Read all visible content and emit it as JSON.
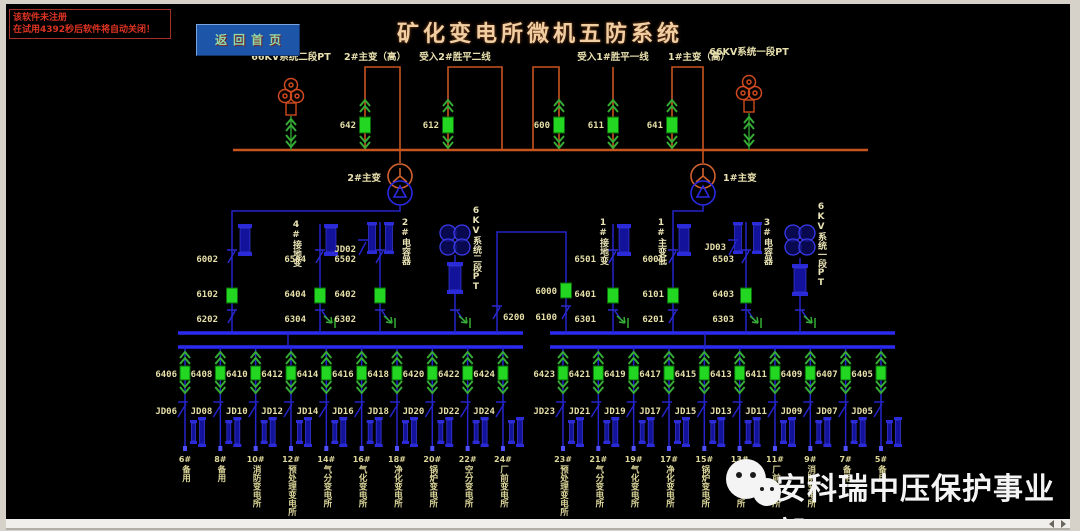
{
  "window": {
    "trial_warning": {
      "line1": "该软件未注册",
      "line2": "在试用4392秒后软件将自动关闭！"
    },
    "home_button_label": "返回首页",
    "title": "矿化变电所微机五防系统",
    "watermark_text": "安科瑞中压保护事业部"
  },
  "colors": {
    "bus_66kv": "#c8541e",
    "bus_6kv": "#2a2af0",
    "breaker_closed": "#22d622",
    "arrow_green": "#35ad35",
    "label_text": "#e6dfa8",
    "title_text": "#f1cfa2",
    "warning_text": "#dd3322",
    "button_bg": "#1d55a8"
  },
  "hv_66kv": {
    "pt_left_label": "66KV系统二段PT",
    "pt_right_label": "66KV系统一段PT",
    "bays": [
      {
        "label": "2#主变（高）",
        "breaker": "642"
      },
      {
        "label": "受入2#胜平二线",
        "breaker": "612"
      },
      {
        "label": "",
        "breaker": "600"
      },
      {
        "label": "受入1#胜平一线",
        "breaker": "611"
      },
      {
        "label": "1#主变（高）",
        "breaker": "641"
      }
    ],
    "transformer_left": "2#主变",
    "transformer_right": "1#主变"
  },
  "mv_6kv": {
    "columns_left": [
      {
        "codes": [
          "6002",
          "6102",
          "6202"
        ]
      },
      {
        "label": "4#接地变",
        "codes": [
          "6504",
          "6404",
          "6304"
        ]
      },
      {
        "label": "2#电容器",
        "jd": "JD02",
        "codes": [
          "6502",
          "6402",
          "6302"
        ]
      },
      {
        "label": "6KV系统二段PT"
      }
    ],
    "bus_tie": {
      "left_switch": "6200",
      "breaker": "6000",
      "right_switch": "6100"
    },
    "columns_right": [
      {
        "label": "1#接地变",
        "codes": [
          "6501",
          "6401",
          "6301"
        ]
      },
      {
        "label": "1#主变低",
        "codes": [
          "6001",
          "6101",
          "6201"
        ]
      },
      {
        "label": "3#电容器",
        "jd": "JD03",
        "codes": [
          "6503",
          "6403",
          "6303"
        ]
      },
      {
        "label": "6KV系统一段PT"
      }
    ]
  },
  "feeders": {
    "left": [
      {
        "breaker": "6406",
        "jd": "JD06",
        "num": "6#",
        "name": "备用"
      },
      {
        "breaker": "6408",
        "jd": "JD08",
        "num": "8#",
        "name": "备用"
      },
      {
        "breaker": "6410",
        "jd": "JD10",
        "num": "10#",
        "name": "消防变电所"
      },
      {
        "breaker": "6412",
        "jd": "JD12",
        "num": "12#",
        "name": "预处理变电所"
      },
      {
        "breaker": "6414",
        "jd": "JD14",
        "num": "14#",
        "name": "气分变电所"
      },
      {
        "breaker": "6416",
        "jd": "JD16",
        "num": "16#",
        "name": "气化变电所"
      },
      {
        "breaker": "6418",
        "jd": "JD18",
        "num": "18#",
        "name": "净化变电所"
      },
      {
        "breaker": "6420",
        "jd": "JD20",
        "num": "20#",
        "name": "锅炉变电所"
      },
      {
        "breaker": "6422",
        "jd": "JD22",
        "num": "22#",
        "name": "空分变电所"
      },
      {
        "breaker": "6424",
        "jd": "JD24",
        "num": "24#",
        "name": "厂前变电所"
      }
    ],
    "right": [
      {
        "breaker": "6423",
        "jd": "JD23",
        "num": "23#",
        "name": "预处理变电所"
      },
      {
        "breaker": "6421",
        "jd": "JD21",
        "num": "21#",
        "name": "气分变电所"
      },
      {
        "breaker": "6419",
        "jd": "JD19",
        "num": "19#",
        "name": "气化变电所"
      },
      {
        "breaker": "6417",
        "jd": "JD17",
        "num": "17#",
        "name": "净化变电所"
      },
      {
        "breaker": "6415",
        "jd": "JD15",
        "num": "15#",
        "name": "锅炉变电所"
      },
      {
        "breaker": "6413",
        "jd": "JD13",
        "num": "13#",
        "name": "空分变电所"
      },
      {
        "breaker": "6411",
        "jd": "JD11",
        "num": "11#",
        "name": "厂前变电所"
      },
      {
        "breaker": "6409",
        "jd": "JD09",
        "num": "9#",
        "name": "消防变电所"
      },
      {
        "breaker": "6407",
        "jd": "JD07",
        "num": "7#",
        "name": "备用"
      },
      {
        "breaker": "6405",
        "jd": "JD05",
        "num": "5#",
        "name": "备用"
      }
    ]
  }
}
